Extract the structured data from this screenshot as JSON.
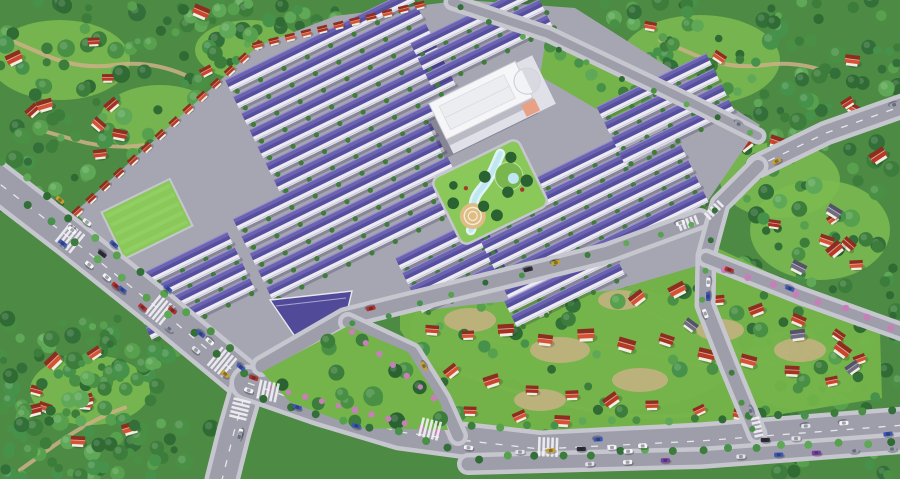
{
  "scene": {
    "width": 900,
    "height": 479,
    "seed": 20240711,
    "kind": "aerial-masterplan-render"
  },
  "palette": {
    "forestBase": "#4d8a43",
    "treeGreens": [
      "#2f6b33",
      "#3c7d3b",
      "#499045",
      "#57a04d",
      "#336f38",
      "#5fa857",
      "#47924b"
    ],
    "treeDark": "#2a6231",
    "meadow": "#7cbb50",
    "grassBright": "#8ac959",
    "grassMid": "#74b44a",
    "stripe": "#9ad46b",
    "dirt": "#cdb087",
    "plate": "#a6a6b2",
    "road": "#9e9eab",
    "sidewalk": "#c6c6cf",
    "marking": "#f2f2f5",
    "roofPurpleLight": "#6b62b2",
    "roofPurpleDark": "#564e9e",
    "roofRidge": "#9a92cc",
    "facade": "#eceaf3",
    "facadeLine": "#c9c8d8",
    "frontTree": "#3f7c3a",
    "roofReds": [
      "#c9452c",
      "#b83a24",
      "#d55234",
      "#a5321f"
    ],
    "roofRedDark": "#8e2e1f",
    "grayRoof": "#6f6c80",
    "wall": "#f1eee4",
    "water": "#bfe7f2",
    "waterEdge": "#e2f3f8",
    "plazaTan": "#ddbd83",
    "mound": "#79b74e",
    "mallWhite": "#f6f6f8",
    "mallPodium": "#e0e1e8",
    "mallInner": "#ecedf1",
    "mallGlass": "#b9bac4",
    "mallAccent": "#e8a087",
    "gateRoof": "#514a99",
    "pink": "#c77fb8",
    "carColors": [
      "#f4f5f7",
      "#f4f5f7",
      "#e2e3e8",
      "#2d2e35",
      "#b42f2a",
      "#7c40a5",
      "#3c57b4",
      "#c7a22e",
      "#f4f5f7",
      "#9aa0ad"
    ],
    "shadow": "rgba(25,25,45,0.22)"
  },
  "meadows": [
    [
      60,
      60,
      70,
      40
    ],
    [
      160,
      120,
      60,
      35
    ],
    [
      700,
      60,
      80,
      45
    ],
    [
      820,
      230,
      70,
      50
    ],
    [
      90,
      390,
      60,
      35
    ],
    [
      620,
      350,
      120,
      60
    ],
    [
      500,
      330,
      90,
      50
    ],
    [
      800,
      370,
      60,
      40
    ],
    [
      780,
      180,
      60,
      38
    ],
    [
      250,
      50,
      55,
      30
    ]
  ],
  "forestRegions": [
    [
      0,
      0,
      270,
      205,
      130
    ],
    [
      190,
      0,
      150,
      38,
      20
    ],
    [
      555,
      0,
      345,
      172,
      160
    ],
    [
      742,
      158,
      158,
      185,
      60
    ],
    [
      768,
      330,
      132,
      149,
      50
    ],
    [
      0,
      318,
      178,
      161,
      100
    ],
    [
      150,
      425,
      95,
      54,
      14
    ]
  ],
  "dirtPaths": [
    [
      [
        10,
        40
      ],
      [
        80,
        70
      ],
      [
        150,
        60
      ],
      [
        220,
        90
      ]
    ],
    [
      [
        40,
        130
      ],
      [
        110,
        150
      ],
      [
        180,
        140
      ]
    ],
    [
      [
        660,
        40
      ],
      [
        730,
        70
      ],
      [
        800,
        60
      ],
      [
        870,
        90
      ]
    ],
    [
      [
        20,
        470
      ],
      [
        90,
        420
      ],
      [
        160,
        395
      ]
    ],
    [
      [
        430,
        320
      ],
      [
        520,
        350
      ],
      [
        610,
        340
      ],
      [
        700,
        370
      ],
      [
        790,
        360
      ]
    ],
    [
      [
        450,
        370
      ],
      [
        540,
        400
      ],
      [
        640,
        420
      ],
      [
        740,
        410
      ]
    ],
    [
      [
        600,
        280
      ],
      [
        660,
        320
      ],
      [
        730,
        350
      ],
      [
        820,
        380
      ]
    ]
  ],
  "village1": {
    "poly": [
      [
        400,
        298
      ],
      [
        560,
        272
      ],
      [
        700,
        240
      ],
      [
        760,
        268
      ],
      [
        880,
        332
      ],
      [
        882,
        398
      ],
      [
        770,
        416
      ],
      [
        600,
        442
      ],
      [
        475,
        442
      ],
      [
        448,
        420
      ],
      [
        420,
        360
      ],
      [
        400,
        330
      ]
    ],
    "patches": [
      [
        470,
        320,
        26,
        12
      ],
      [
        560,
        350,
        30,
        13
      ],
      [
        640,
        380,
        28,
        12
      ],
      [
        720,
        330,
        24,
        11
      ],
      [
        540,
        400,
        26,
        11
      ],
      [
        800,
        350,
        26,
        12
      ],
      [
        620,
        300,
        22,
        10
      ]
    ],
    "trees": 52,
    "redHouses": [
      [
        445,
        300
      ],
      [
        483,
        289
      ],
      [
        522,
        287
      ],
      [
        558,
        299
      ],
      [
        598,
        284
      ],
      [
        638,
        299
      ],
      [
        678,
        291
      ],
      [
        718,
        301
      ],
      [
        757,
        311
      ],
      [
        798,
        321
      ],
      [
        838,
        336
      ],
      [
        860,
        360
      ],
      [
        432,
        331
      ],
      [
        468,
        336
      ],
      [
        506,
        331
      ],
      [
        545,
        341
      ],
      [
        586,
        336
      ],
      [
        626,
        346
      ],
      [
        666,
        341
      ],
      [
        706,
        356
      ],
      [
        748,
        362
      ],
      [
        792,
        372
      ],
      [
        832,
        382
      ],
      [
        452,
        372
      ],
      [
        492,
        382
      ],
      [
        532,
        391
      ],
      [
        572,
        396
      ],
      [
        612,
        401
      ],
      [
        652,
        406
      ],
      [
        700,
        411
      ],
      [
        740,
        416
      ],
      [
        470,
        412
      ],
      [
        520,
        417
      ],
      [
        562,
        422
      ]
    ],
    "grayHouses": [
      [
        543,
        312
      ],
      [
        690,
        326
      ],
      [
        812,
        300
      ],
      [
        798,
        336
      ]
    ]
  },
  "villageRegions": [
    {
      "bbox": [
        8,
        8,
        240,
        150
      ],
      "houses": 13,
      "gray": 0
    },
    {
      "bbox": [
        648,
        8,
        240,
        150
      ],
      "houses": 11,
      "gray": 0
    },
    {
      "bbox": [
        755,
        190,
        135,
        125
      ],
      "houses": 6,
      "gray": 2
    },
    {
      "bbox": [
        8,
        338,
        150,
        130
      ],
      "houses": 9,
      "gray": 0
    },
    {
      "bbox": [
        785,
        340,
        105,
        120
      ],
      "houses": 2,
      "gray": 1
    }
  ],
  "development": {
    "plate": [
      [
        258,
        46
      ],
      [
        335,
        16
      ],
      [
        465,
        0
      ],
      [
        575,
        8
      ],
      [
        760,
        125
      ],
      [
        705,
        205
      ],
      [
        700,
        265
      ],
      [
        615,
        290
      ],
      [
        470,
        305
      ],
      [
        345,
        320
      ],
      [
        300,
        335
      ],
      [
        258,
        372
      ],
      [
        150,
        290
      ],
      [
        75,
        212
      ]
    ],
    "clusters": [
      {
        "cx": 345,
        "cy": 92,
        "rows": 7,
        "len": 205,
        "sp": 18.5
      },
      {
        "cx": 352,
        "cy": 212,
        "rows": 5,
        "len": 220,
        "sp": 19
      },
      {
        "cx": 190,
        "cy": 287,
        "rows": 4,
        "len": 115,
        "sp": 17
      },
      {
        "cx": 452,
        "cy": 266,
        "rows": 4,
        "len": 95,
        "sp": 16
      },
      {
        "cx": 588,
        "cy": 208,
        "rows": 6,
        "len": 222,
        "sp": 17
      },
      {
        "cx": 666,
        "cy": 110,
        "rows": 4,
        "len": 122,
        "sp": 17
      },
      {
        "cx": 482,
        "cy": 36,
        "rows": 3,
        "len": 135,
        "sp": 17
      },
      {
        "cx": 565,
        "cy": 289,
        "rows": 2,
        "len": 120,
        "sp": 16
      }
    ],
    "angle": -26,
    "redStrips": [
      {
        "from": [
          78,
          212
        ],
        "to": [
          258,
          46
        ],
        "count": 14
      },
      {
        "from": [
          258,
          46
        ],
        "to": [
          420,
          6
        ],
        "count": 11
      }
    ],
    "lawn": {
      "cx": 147,
      "cy": 219,
      "w": 76,
      "h": 52
    },
    "greenStrip": {
      "poly": [
        [
          546,
          38
        ],
        [
          652,
          88
        ],
        [
          622,
          124
        ],
        [
          540,
          76
        ]
      ],
      "treeLine": [
        [
          552,
          52
        ],
        [
          640,
          100
        ]
      ],
      "trees": 9
    },
    "gate": {
      "poly": [
        [
          270,
          300
        ],
        [
          352,
          291
        ],
        [
          342,
          333
        ],
        [
          296,
          338
        ]
      ]
    }
  },
  "mall": {
    "cx": 487,
    "cy": 104,
    "angle": -26
  },
  "park": {
    "cx": 490,
    "cy": 192,
    "angle": -26,
    "w": 96,
    "h": 74
  },
  "treePark": {
    "poly": [
      [
        262,
        372
      ],
      [
        348,
        326
      ],
      [
        408,
        352
      ],
      [
        440,
        402
      ],
      [
        448,
        430
      ],
      [
        360,
        428
      ],
      [
        290,
        402
      ]
    ],
    "trees": 16,
    "shrubLines": [
      {
        "from": [
          272,
          388
        ],
        "to": [
          438,
          432
        ],
        "count": 11
      },
      {
        "from": [
          352,
          332
        ],
        "to": [
          434,
          398
        ],
        "count": 7
      }
    ]
  },
  "roads": [
    {
      "name": "boulevard-west",
      "pts": [
        [
          -12,
          175
        ],
        [
          70,
          238
        ],
        [
          160,
          310
        ],
        [
          248,
          383
        ]
      ],
      "w": 32,
      "dash": true,
      "cars": 9
    },
    {
      "name": "boulevard-south-exit",
      "pts": [
        [
          248,
          383
        ],
        [
          234,
          432
        ],
        [
          222,
          480
        ]
      ],
      "w": 26,
      "dash": true,
      "cars": 2
    },
    {
      "name": "south-boulevard",
      "pts": [
        [
          248,
          383
        ],
        [
          320,
          408
        ],
        [
          400,
          432
        ],
        [
          460,
          440
        ],
        [
          540,
          449
        ],
        [
          700,
          441
        ],
        [
          905,
          425
        ]
      ],
      "w": 28,
      "dash": true,
      "cars": 9
    },
    {
      "name": "south-parking-lane",
      "pts": [
        [
          468,
          464
        ],
        [
          700,
          458
        ],
        [
          902,
          443
        ]
      ],
      "w": 13,
      "dash": false,
      "cars": 0
    },
    {
      "name": "village-edge-road",
      "pts": [
        [
          262,
          366
        ],
        [
          345,
          318
        ],
        [
          470,
          287
        ],
        [
          608,
          253
        ],
        [
          700,
          219
        ]
      ],
      "w": 13,
      "dash": false,
      "cars": 4
    },
    {
      "name": "treepark-branch",
      "pts": [
        [
          348,
          322
        ],
        [
          412,
          352
        ],
        [
          442,
          400
        ],
        [
          458,
          436
        ]
      ],
      "w": 11,
      "dash": false,
      "cars": 1
    },
    {
      "name": "northeast-highway",
      "pts": [
        [
          908,
          104
        ],
        [
          826,
          133
        ],
        [
          758,
          166
        ]
      ],
      "w": 16,
      "dash": true,
      "cars": 2
    },
    {
      "name": "east-edge-road",
      "pts": [
        [
          758,
          166
        ],
        [
          720,
          204
        ],
        [
          706,
          256
        ],
        [
          705,
          305
        ],
        [
          729,
          366
        ],
        [
          757,
          434
        ]
      ],
      "w": 12,
      "dash": false,
      "cars": 4
    },
    {
      "name": "east-branch-road",
      "pts": [
        [
          706,
          258
        ],
        [
          802,
          296
        ],
        [
          908,
          334
        ]
      ],
      "w": 10,
      "dash": false,
      "cars": 2
    },
    {
      "name": "north-boundary-road",
      "pts": [
        [
          452,
          2
        ],
        [
          548,
          34
        ],
        [
          692,
          103
        ],
        [
          758,
          136
        ]
      ],
      "w": 8,
      "dash": false,
      "cars": 1
    }
  ],
  "crosswalks": [
    [
      222,
      362,
      39,
      30
    ],
    [
      160,
      310,
      39,
      30
    ],
    [
      70,
      238,
      39,
      30
    ],
    [
      268,
      391,
      12,
      24
    ],
    [
      240,
      409,
      104,
      22
    ],
    [
      430,
      429,
      14,
      24
    ],
    [
      548,
      447,
      2,
      24
    ],
    [
      757,
      427,
      78,
      11
    ],
    [
      688,
      223,
      -21,
      12
    ],
    [
      714,
      210,
      -45,
      11
    ]
  ],
  "roadTreeLines": [
    {
      "from": [
        2,
        160
      ],
      "to": [
        232,
        350
      ],
      "count": 11,
      "r": 4
    },
    {
      "from": [
        26,
        204
      ],
      "to": [
        242,
        372
      ],
      "count": 10,
      "r": 4
    },
    {
      "from": [
        262,
        400
      ],
      "to": [
        450,
        446
      ],
      "count": 8,
      "r": 4
    },
    {
      "from": [
        470,
        427
      ],
      "to": [
        892,
        412
      ],
      "count": 16,
      "r": 4
    },
    {
      "from": [
        480,
        458
      ],
      "to": [
        894,
        442
      ],
      "count": 16,
      "r": 4
    },
    {
      "from": [
        712,
        212
      ],
      "to": [
        700,
        300
      ],
      "count": 4,
      "r": 3
    },
    {
      "from": [
        733,
        374
      ],
      "to": [
        754,
        428
      ],
      "count": 3,
      "r": 3
    },
    {
      "from": [
        352,
        324
      ],
      "to": [
        692,
        225
      ],
      "count": 11,
      "r": 3
    },
    {
      "from": [
        458,
        8
      ],
      "to": [
        752,
        133
      ],
      "count": 10,
      "r": 3
    },
    {
      "from": [
        722,
        268
      ],
      "to": [
        892,
        327
      ],
      "count": 8,
      "r": 3.5,
      "pink": true
    }
  ],
  "parkedRows": [
    {
      "from": [
        36,
        222
      ],
      "to": [
        196,
        350
      ],
      "count": 7
    },
    {
      "from": [
        60,
        200
      ],
      "to": [
        222,
        333
      ],
      "count": 7
    },
    {
      "from": [
        520,
        452
      ],
      "to": [
        888,
        434
      ],
      "count": 13
    },
    {
      "from": [
        552,
        466
      ],
      "to": [
        892,
        449
      ],
      "count": 10
    }
  ]
}
